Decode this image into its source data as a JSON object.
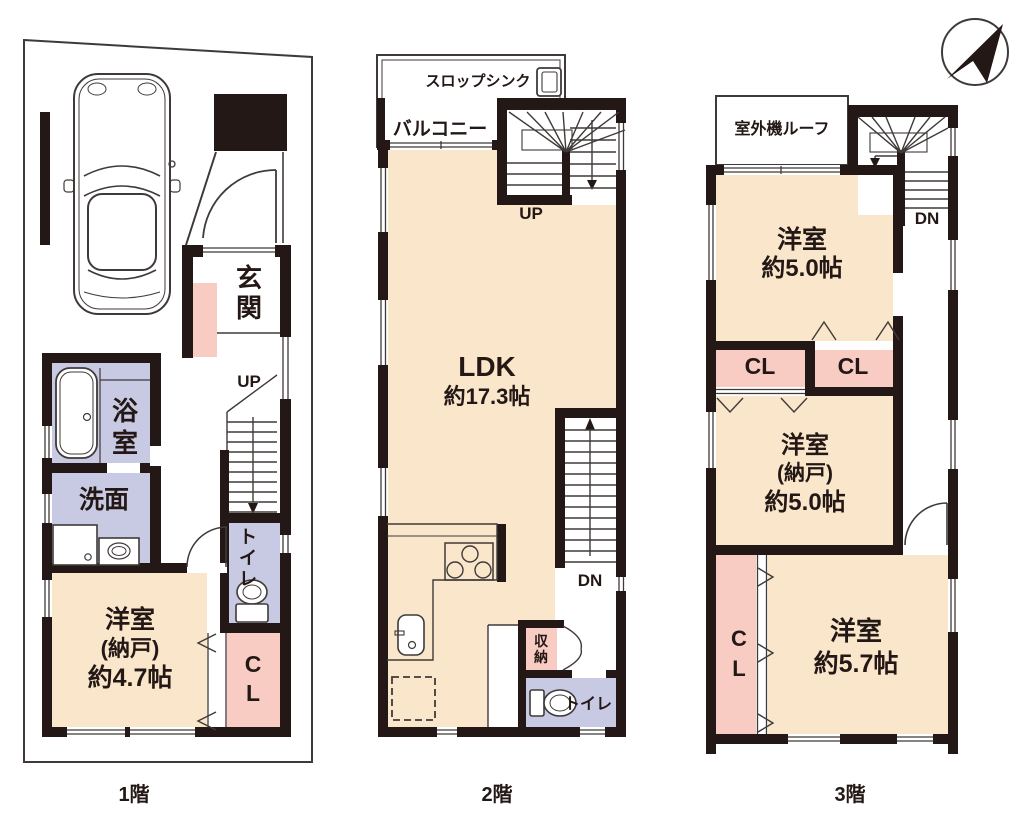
{
  "colors": {
    "wall": "#231815",
    "line": "#3F3A39",
    "room": "#FAE6CB",
    "closet": "#F8CBC3",
    "wet": "#C8C9E3",
    "paper": "#FFFFFF"
  },
  "compass": {
    "icon": "north-arrow"
  },
  "floors": {
    "f1": {
      "label": "1階",
      "entrance": "玄関",
      "up": "UP",
      "bath": "浴室",
      "washroom": "洗面",
      "toilet": "トイレ",
      "closet": "CL",
      "room": {
        "line1": "洋室",
        "line2": "(納戸)",
        "line3": "約4.7帖"
      }
    },
    "f2": {
      "label": "2階",
      "slop_sink": "スロップシンク",
      "balcony": "バルコニー",
      "up": "UP",
      "dn": "DN",
      "storage": "収納",
      "toilet": "トイレ",
      "ldk": {
        "line1": "LDK",
        "line2": "約17.3帖"
      }
    },
    "f3": {
      "label": "3階",
      "outdoor_unit_roof": "室外機ルーフ",
      "dn": "DN",
      "closet1": "CL",
      "closet2": "CL",
      "closet3": "CL",
      "room1": {
        "line1": "洋室",
        "line2": "約5.0帖"
      },
      "room2": {
        "line1": "洋室",
        "line2": "(納戸)",
        "line3": "約5.0帖"
      },
      "room3": {
        "line1": "洋室",
        "line2": "約5.7帖"
      }
    }
  }
}
